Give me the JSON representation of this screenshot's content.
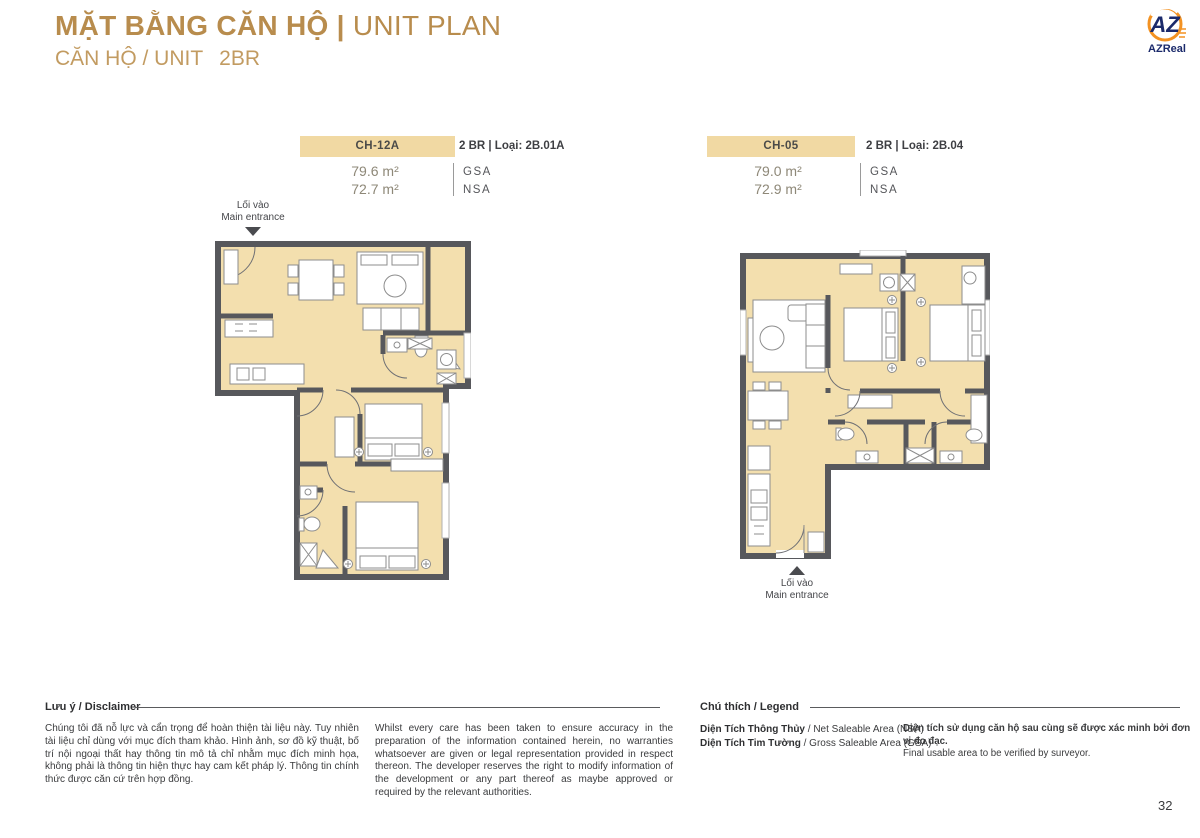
{
  "page": {
    "title_vi": "MẶT BẰNG CĂN HỘ ",
    "title_sep": "| ",
    "title_en": "UNIT PLAN",
    "subtitle_label": "CĂN HỘ / UNIT",
    "subtitle_value": "2BR",
    "page_number": "32"
  },
  "logo": {
    "monogram": "AZ",
    "name": "AZReal"
  },
  "units": [
    {
      "code": "CH-12A",
      "type_label": "2 BR | Loại: 2B.01A",
      "areas": [
        {
          "value": "79.6 m²",
          "label": "GSA"
        },
        {
          "value": "72.7 m²",
          "label": "NSA"
        }
      ],
      "entrance_vi": "Lối vào",
      "entrance_en": "Main entrance"
    },
    {
      "code": "CH-05",
      "type_label": "2 BR | Loại: 2B.04",
      "areas": [
        {
          "value": "79.0 m²",
          "label": "GSA"
        },
        {
          "value": "72.9 m²",
          "label": "NSA"
        }
      ],
      "entrance_vi": "Lối vào",
      "entrance_en": "Main entrance"
    }
  ],
  "disclaimer": {
    "heading": "Lưu ý / Disclaimer",
    "text_vi": "Chúng tôi đã nỗ lực và cẩn trọng để hoàn thiện tài liệu này. Tuy nhiên tài liệu chỉ dùng với mục đích tham khảo. Hình ảnh, sơ đồ kỹ thuật, bố trí nội ngoại thất hay thông tin mô tả chỉ nhằm mục đích minh họa, không phải là thông tin hiện thực hay cam kết pháp lý. Thông tin chính thức được căn cứ trên hợp đồng.",
    "text_en": "Whilst every care has been taken to ensure accuracy in the preparation of the information contained herein, no warranties whatsoever are given or legal representation provided in respect thereon. The developer reserves the right to modify information of the development or any part thereof as maybe approved or required by the relevant authorities."
  },
  "legend": {
    "heading": "Chú thích / Legend",
    "items": [
      {
        "bold": "Diện Tích Thông Thủy",
        "rest": " / Net Saleable Area (NSA)"
      },
      {
        "bold": "Diện Tích Tim Tường",
        "rest": " / Gross Saleable Area (GSA)"
      }
    ],
    "note_vi": "Diện tích sử dụng căn hộ sau cùng sẽ được xác minh bởi đơn vị đo đạc.",
    "note_en": "Final usable area to be verified by surveyor."
  },
  "colors": {
    "title_gold": "#b88c4d",
    "badge_tan": "#f1d9a3",
    "floor_tan": "#f3dfae",
    "wall_gray": "#57585c",
    "logo_navy": "#1b2a6b",
    "logo_orange": "#f39222"
  }
}
